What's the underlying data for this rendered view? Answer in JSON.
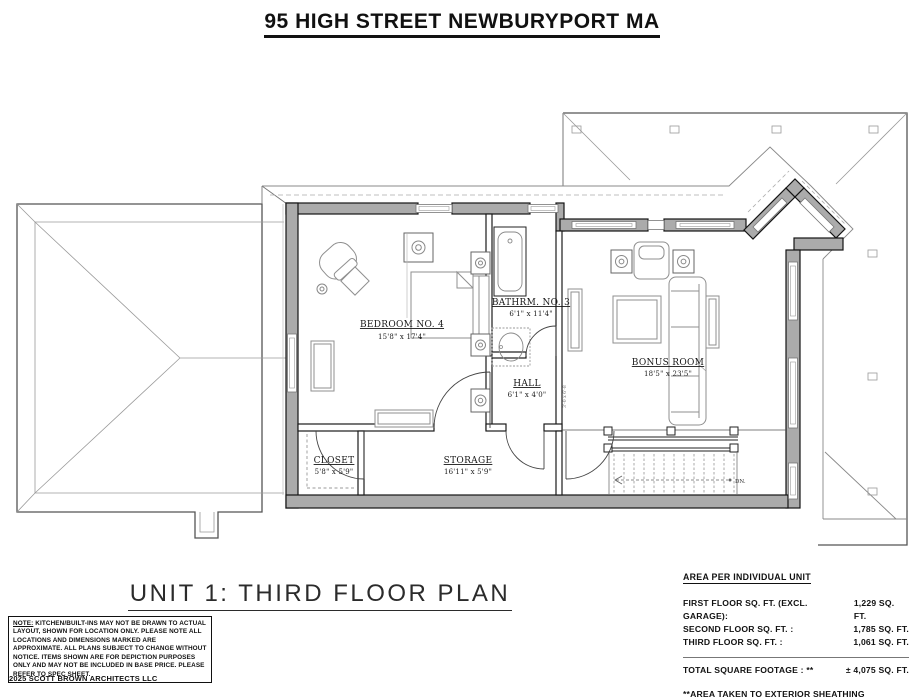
{
  "page": {
    "title": "95 HIGH STREET NEWBURYPORT MA",
    "plan_title": "UNIT 1: THIRD FLOOR PLAN",
    "copyright": "2025 SCOTT BROWN ARCHITECTS LLC"
  },
  "plan": {
    "rooms": {
      "bedroom": {
        "name": "BEDROOM NO. 4",
        "dims": "15'8\" x 17'4\""
      },
      "bathroom": {
        "name": "BATHRM. NO. 3",
        "dims": "6'1\" x 11'4\""
      },
      "hall": {
        "name": "HALL",
        "dims": "6'1\" x 4'0\""
      },
      "bonus": {
        "name": "BONUS ROOM",
        "dims": "18'5\" x 23'5\""
      },
      "closet": {
        "name": "CLOSET",
        "dims": "5'8\" x 5'9\""
      },
      "storage": {
        "name": "STORAGE",
        "dims": "16'11\" x 5'9\""
      }
    },
    "stair_label": "DN.",
    "door_label": "3'-0 x 6'-8"
  },
  "note": {
    "label": "NOTE:",
    "text": " KITCHEN/BUILT-INS MAY NOT BE DRAWN TO ACTUAL LAYOUT, SHOWN FOR LOCATION ONLY. PLEASE NOTE ALL LOCATIONS AND DIMENSIONS MARKED ARE APPROXIMATE. ALL PLANS SUBJECT TO CHANGE WITHOUT NOTICE. ITEMS SHOWN ARE FOR DEPICTION PURPOSES ONLY AND MAY NOT BE INCLUDED IN BASE PRICE. PLEASE REFER TO SPEC SHEET."
  },
  "area": {
    "heading": "AREA PER INDIVIDUAL UNIT",
    "rows": [
      {
        "label": "FIRST FLOOR SQ. FT. (EXCL. GARAGE):",
        "value": "1,229 SQ. FT."
      },
      {
        "label": "SECOND FLOOR SQ. FT. :",
        "value": "1,785 SQ. FT."
      },
      {
        "label": "THIRD FLOOR SQ. FT. :",
        "value": "1,061 SQ. FT."
      }
    ],
    "total_label": "TOTAL SQUARE FOOTAGE : **",
    "total_value": "± 4,075 SQ. FT.",
    "footnote": "**AREA TAKEN TO EXTERIOR SHEATHING"
  },
  "colors": {
    "wall_fill": "#ababab",
    "line": "#1a1a1a",
    "roof_line": "#9a9a9a"
  }
}
